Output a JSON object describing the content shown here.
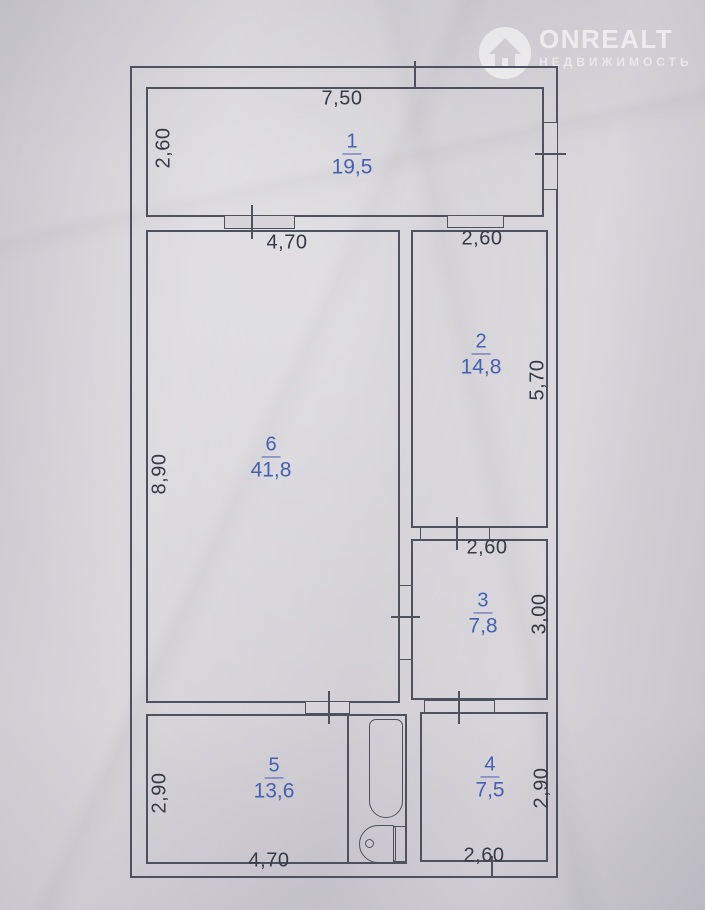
{
  "watermark": {
    "brand": "ONREALT",
    "subtitle": "НЕДВИЖИМОСТЬ"
  },
  "rooms": [
    {
      "number": "1",
      "area": "19,5"
    },
    {
      "number": "2",
      "area": "14,8"
    },
    {
      "number": "3",
      "area": "7,8"
    },
    {
      "number": "4",
      "area": "7,5"
    },
    {
      "number": "5",
      "area": "13,6"
    },
    {
      "number": "6",
      "area": "41,8"
    }
  ],
  "dimensions": {
    "room1_width": "7,50",
    "room1_height": "2,60",
    "room6_width_top": "4,70",
    "room6_height": "8,90",
    "room2_width": "2,60",
    "room2_height": "5,70",
    "room3_width": "2,60",
    "room3_height": "3,00",
    "room5_height": "2,90",
    "room5_width": "4,70",
    "room4_height": "2,90",
    "room4_width": "2,60"
  },
  "colors": {
    "paper": "#d5d3d8",
    "line": "#4d525d",
    "dimension_text": "#363a44",
    "room_text": "#4660b2",
    "watermark": "#ffffff"
  }
}
